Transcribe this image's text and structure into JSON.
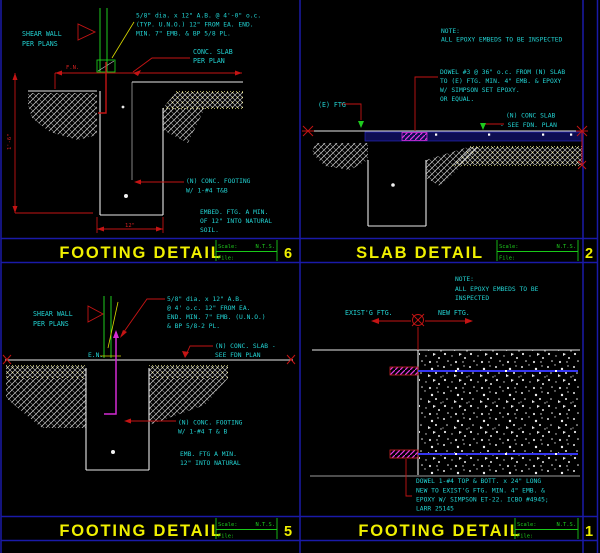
{
  "sheet": {
    "background": "#000000",
    "colors": {
      "annotation_cyan": "#22d2d2",
      "title_yellow": "#f0f000",
      "dimension_red": "#c41414",
      "titleblock_green": "#19c919",
      "grid_blue": "#1a1aa8",
      "dowel_magenta": "#d42ad4",
      "rebar_blue": "#3535f0",
      "line_white": "#e9e9e9"
    }
  },
  "panels": {
    "footing6": {
      "title": "FOOTING DETAIL",
      "number": "6",
      "scale_label": "Scale:",
      "scale_value": "N.T.S.",
      "file_label": "File:",
      "shear_wall": [
        "SHEAR WALL",
        "PER PLANS"
      ],
      "ab_note": [
        "5/8\" dia. x 12\" A.B. @ 4'-0\" o.c.",
        "(TYP. U.N.O.) 12\" FROM EA. END.",
        "MIN. 7\" EMB. & BP 5/8 PL."
      ],
      "conc_slab": [
        "CONC. SLAB",
        "PER PLAN"
      ],
      "footing_note": [
        "(N) CONC. FOOTING",
        "W/ 1-#4 T&B"
      ],
      "embed_note": [
        "EMBED. FTG. A MIN.",
        "OF 12\" INTO NATURAL",
        "SOIL."
      ],
      "fn_label": "F.N.",
      "dim_left": "1'-6\"",
      "dim_bottom": "12\""
    },
    "slab2": {
      "title": "SLAB DETAIL",
      "number": "2",
      "scale_label": "Scale:",
      "scale_value": "N.T.S.",
      "file_label": "File:",
      "note": [
        "NOTE:",
        "ALL EPOXY EMBEDS TO BE INSPECTED"
      ],
      "dowel_note": [
        "DOWEL #3 @ 36\" o.c. FROM (N) SLAB",
        "TO (E) FTG.  MIN. 4\" EMB. & EPOXY",
        "W/ SIMPSON SET EPOXY.",
        "OR EQUAL."
      ],
      "e_ftg": "(E) FTG",
      "conc_slab": [
        "(N) CONC SLAB",
        "- SEE FDN. PLAN"
      ]
    },
    "footing5": {
      "title": "FOOTING DETAIL",
      "number": "5",
      "scale_label": "Scale:",
      "scale_value": "N.T.S.",
      "file_label": "File:",
      "shear_wall": [
        "SHEAR WALL",
        "PER PLANS"
      ],
      "ab_note": [
        "5/8\" dia. x 12\" A.B.",
        "@ 4' o.c. 12\" FROM EA.",
        "END. MIN. 7\" EMB. (U.N.O.)",
        "& BP 5/8-2 PL."
      ],
      "en_label": "E.N.",
      "conc_slab": [
        "(N) CONC. SLAB -",
        "SEE FDN PLAN"
      ],
      "footing_note": [
        "(N) CONC. FOOTING",
        "W/ 1-#4 T & B"
      ],
      "embed_note": [
        "EMB. FTG A MIN.",
        "12\" INTO NATURAL"
      ]
    },
    "footing1": {
      "title": "FOOTING DETAIL",
      "number": "1",
      "scale_label": "Scale:",
      "scale_value": "N.T.S.",
      "file_label": "File:",
      "note": [
        "NOTE:",
        "ALL EPOXY EMBEDS TO BE",
        "INSPECTED"
      ],
      "existing_ftg": "EXIST'G FTG.",
      "new_ftg": "NEW FTG.",
      "dowel_note": [
        "DOWEL 1-#4 TOP & BOTT. x 24\" LONG",
        "NEW TO EXIST'G FTG.  MIN. 4\" EMB. &",
        "EPOXY W/ SIMPSON ET-22.  ICBO #4945;",
        "LARR 25145"
      ]
    }
  }
}
